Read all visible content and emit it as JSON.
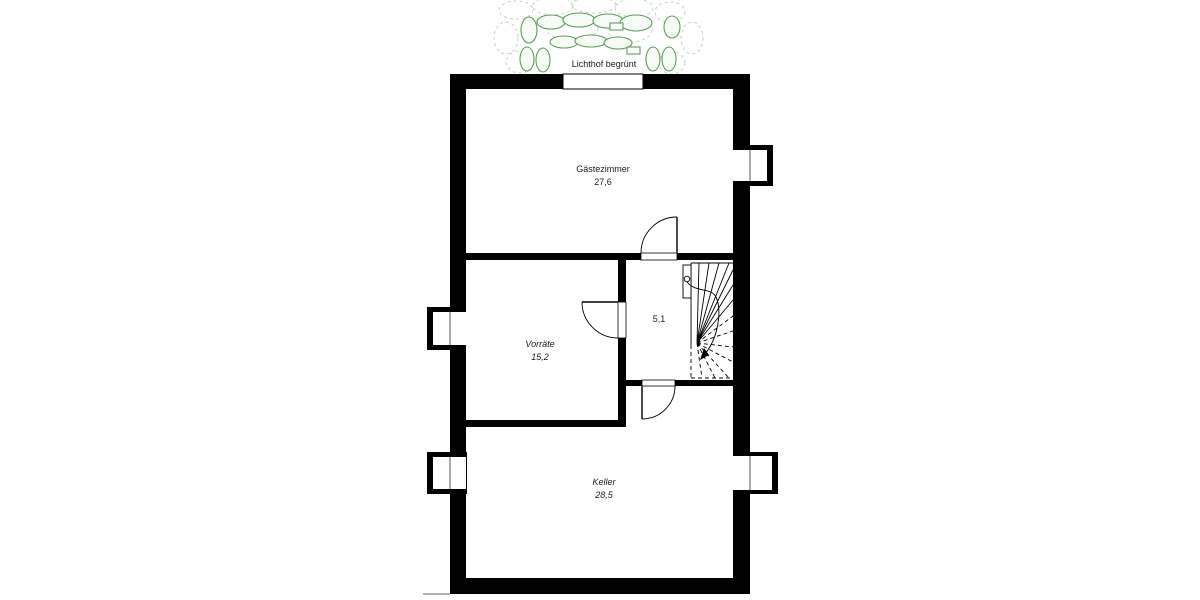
{
  "drawing": {
    "caption_lichthof": "Lichthof begrünt",
    "rooms": [
      {
        "name": "Gästezimmer",
        "area": "27,6"
      },
      {
        "name": "Vorräte",
        "area": "15,2"
      },
      {
        "area": "5,1"
      },
      {
        "name": "Keller",
        "area": "28,5"
      }
    ],
    "colors": {
      "wall": "#000000",
      "label": "#1a1a1a",
      "plant_green": "#5a9e5a",
      "plant_faint": "#c2d2c2",
      "ground_line": "#999999"
    }
  }
}
